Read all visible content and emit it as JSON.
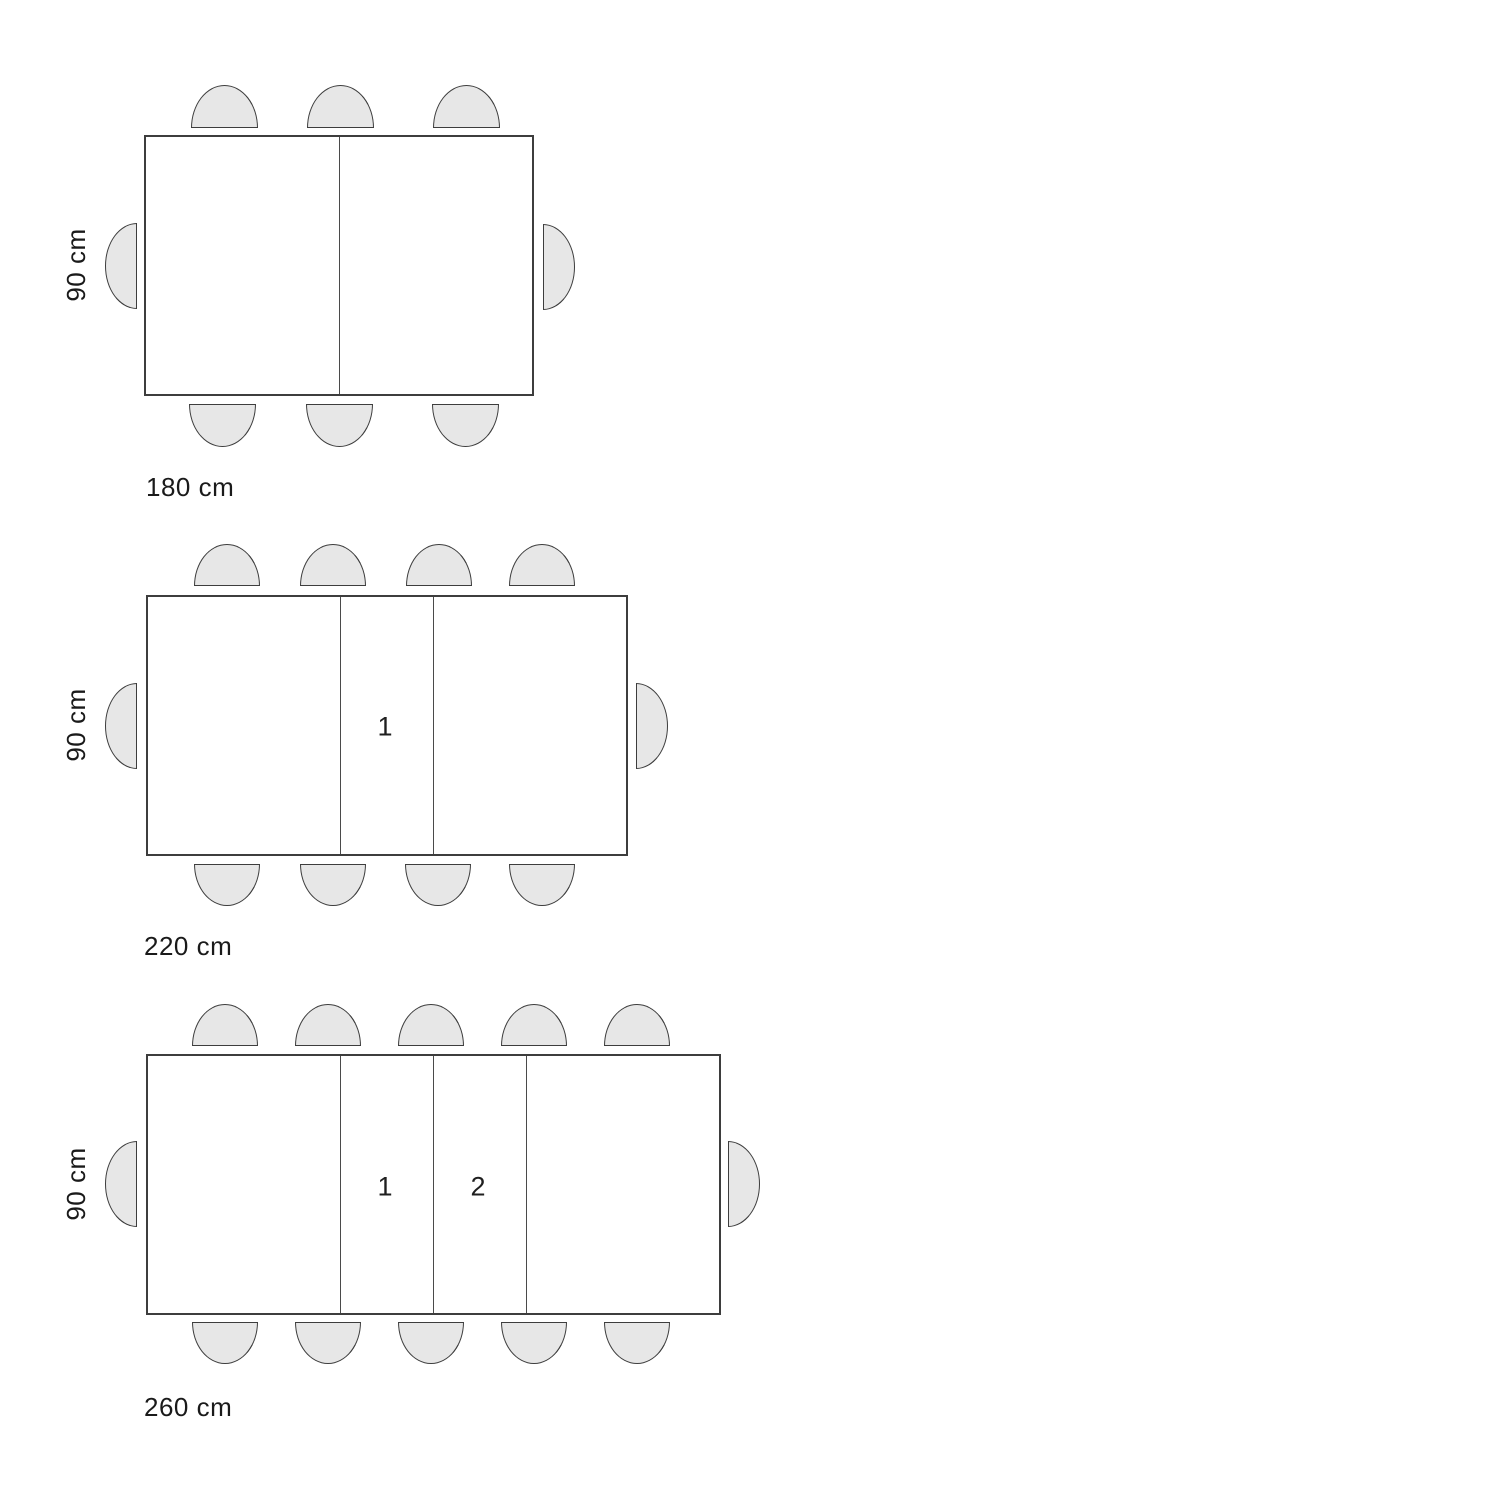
{
  "colors": {
    "background": "#ffffff",
    "chair_fill": "#e7e7e7",
    "line_stroke": "#3d3d3d",
    "text": "#1a1a1a"
  },
  "diagrams": [
    {
      "name": "table-180cm",
      "width_label": "180 cm",
      "height_label": "90 cm",
      "leaf_labels": [],
      "table": {
        "x": 144,
        "y": 135,
        "w": 390,
        "h": 261,
        "dividers": [
          194
        ]
      },
      "chairs": {
        "size_horizontal": {
          "w": 67,
          "h": 43
        },
        "size_vertical": {
          "w": 32,
          "h": 86
        },
        "top": {
          "y": 85,
          "centers": [
            224,
            340,
            466
          ]
        },
        "bottom": {
          "y": 404,
          "centers": [
            222,
            339,
            465
          ]
        },
        "left": {
          "x": 105,
          "y": 223
        },
        "right": {
          "x": 543,
          "y": 224
        }
      },
      "label_positions": {
        "width": {
          "x": 146,
          "y": 474
        },
        "height": {
          "cx": 76,
          "cy": 265
        }
      }
    },
    {
      "name": "table-220cm",
      "width_label": "220 cm",
      "height_label": "90 cm",
      "leaf_labels": [
        {
          "text": "1",
          "cx": 385,
          "cy": 727
        }
      ],
      "table": {
        "x": 146,
        "y": 595,
        "w": 482,
        "h": 261,
        "dividers": [
          193,
          286
        ]
      },
      "chairs": {
        "size_horizontal": {
          "w": 66,
          "h": 42
        },
        "size_vertical": {
          "w": 32,
          "h": 86
        },
        "top": {
          "y": 544,
          "centers": [
            227,
            333,
            439,
            542
          ]
        },
        "bottom": {
          "y": 864,
          "centers": [
            227,
            333,
            438,
            542
          ]
        },
        "left": {
          "x": 105,
          "y": 683
        },
        "right": {
          "x": 636,
          "y": 683
        }
      },
      "label_positions": {
        "width": {
          "x": 144,
          "y": 933
        },
        "height": {
          "cx": 76,
          "cy": 725
        }
      }
    },
    {
      "name": "table-260cm",
      "width_label": "260 cm",
      "height_label": "90 cm",
      "leaf_labels": [
        {
          "text": "1",
          "cx": 385,
          "cy": 1187
        },
        {
          "text": "2",
          "cx": 478,
          "cy": 1187
        }
      ],
      "table": {
        "x": 146,
        "y": 1054,
        "w": 575,
        "h": 261,
        "dividers": [
          193,
          286,
          379
        ]
      },
      "chairs": {
        "size_horizontal": {
          "w": 66,
          "h": 42
        },
        "size_vertical": {
          "w": 32,
          "h": 86
        },
        "top": {
          "y": 1004,
          "centers": [
            225,
            328,
            431,
            534,
            637
          ]
        },
        "bottom": {
          "y": 1322,
          "centers": [
            225,
            328,
            431,
            534,
            637
          ]
        },
        "left": {
          "x": 105,
          "y": 1141
        },
        "right": {
          "x": 728,
          "y": 1141
        }
      },
      "label_positions": {
        "width": {
          "x": 144,
          "y": 1394
        },
        "height": {
          "cx": 76,
          "cy": 1184
        }
      }
    }
  ]
}
